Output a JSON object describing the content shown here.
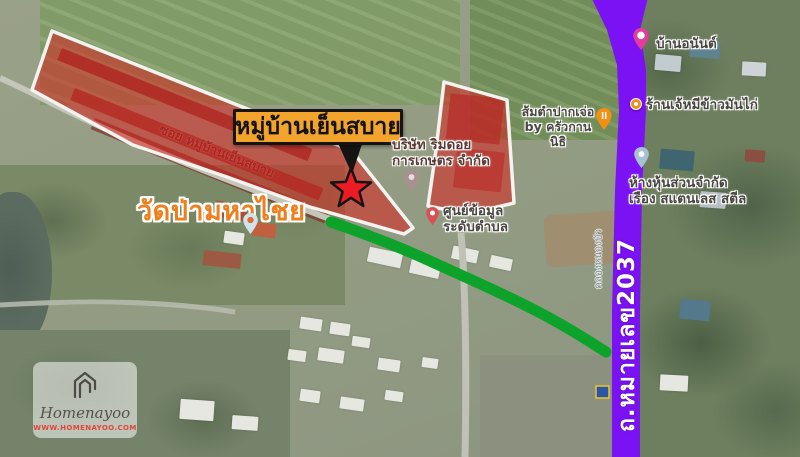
{
  "annotation": {
    "village_callout": "หมู่บ้านเย็นสบาย",
    "street_in_zone": "ซอย หมู่บ้านเย็นสบาย",
    "temple": "วัดป่ามหาไชย",
    "highway": "ถ.หมายเลข2037",
    "canal": "คลองหนองบัว"
  },
  "pois": {
    "ban_anan": {
      "label": "บ้านอนันต์"
    },
    "chicken_rice": {
      "label": "ร้านเจ้หมีข้าวมันไก่"
    },
    "somtam": {
      "line1": "ส้มตำปากเจ่อ",
      "line2": "by ครัวกานนิธิ"
    },
    "rimdoi": {
      "line1": "บริษัท ริมดอย",
      "line2": "การเกษตร จำกัด"
    },
    "info_center": {
      "line1": "ศูนย์ข้อมูล",
      "line2": "ระดับตำบล"
    },
    "stainless": {
      "line1": "ห้างหุ้นส่วนจำกัด",
      "line2": "เรือง สแตนเลส สตีล"
    }
  },
  "watermark": {
    "brand": "Homenayoo",
    "url": "WWW.HOMENAYOO.COM"
  },
  "colors": {
    "zone_red": "#dc1c1a",
    "zone_border": "#f5f3ef",
    "route_green": "#0da32b",
    "highway_purple": "#7b12f3",
    "callout_bg": "#f2a42d",
    "star_red": "#ed1c24",
    "temple_orange": "#ef7f1d",
    "watermark_url_red": "#e2453c"
  }
}
